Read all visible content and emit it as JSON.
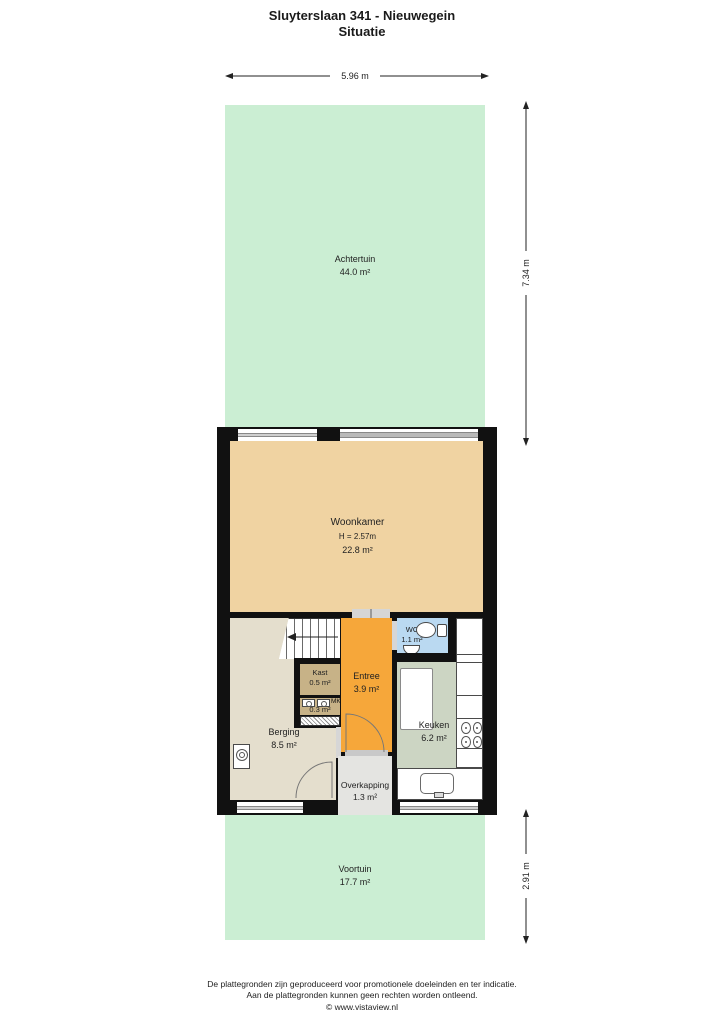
{
  "title": {
    "line1": "Sluyterslaan 341 - Nieuwegein",
    "line2": "Situatie"
  },
  "dimensions": {
    "top_width": "5.96 m",
    "right_upper": "7.34 m",
    "right_lower": "2.91 m"
  },
  "rooms": {
    "achtertuin": {
      "name": "Achtertuin",
      "area": "44.0 m²"
    },
    "woonkamer": {
      "name": "Woonkamer",
      "height_label": "H = 2.57m",
      "area": "22.8 m²"
    },
    "berging": {
      "name": "Berging",
      "area": "8.5 m²"
    },
    "kast": {
      "name": "Kast",
      "area": "0.5 m²"
    },
    "meterkast": {
      "name": "MK",
      "area": "0.3 m²"
    },
    "entree": {
      "name": "Entree",
      "area": "3.9 m²"
    },
    "wc": {
      "name": "WC",
      "area": "1.1 m²"
    },
    "keuken": {
      "name": "Keuken",
      "area": "6.2 m²"
    },
    "overkapping": {
      "name": "Overkapping",
      "area": "1.3 m²"
    },
    "voortuin": {
      "name": "Voortuin",
      "area": "17.7 m²"
    }
  },
  "icons": {
    "toilet": "toilet-icon",
    "sink": "sink-icon",
    "stove": "stove-icon",
    "water_heater": "water-heater-icon",
    "meters": "utility-meter-icon",
    "stairs": "staircase",
    "door_arcs": "door-swing-arc",
    "dimension_arrows": "dimension-arrow"
  },
  "colors": {
    "garden_green": "#cbeed3",
    "woonkamer_tan": "#f0d3a2",
    "entree_orange": "#f6a73a",
    "berging_beige": "#e4decd",
    "kast_brown": "#c7b287",
    "wc_blue": "#bad9f1",
    "keuken_sage": "#ccd5c3",
    "overkapping_gray": "#e4e4e1",
    "wall": "#111111"
  },
  "footer": {
    "line1": "De plattegronden zijn geproduceerd voor promotionele doeleinden en ter indicatie.",
    "line2": "Aan de plattegronden kunnen geen rechten worden ontleend.",
    "line3": "© www.vistaview.nl"
  }
}
